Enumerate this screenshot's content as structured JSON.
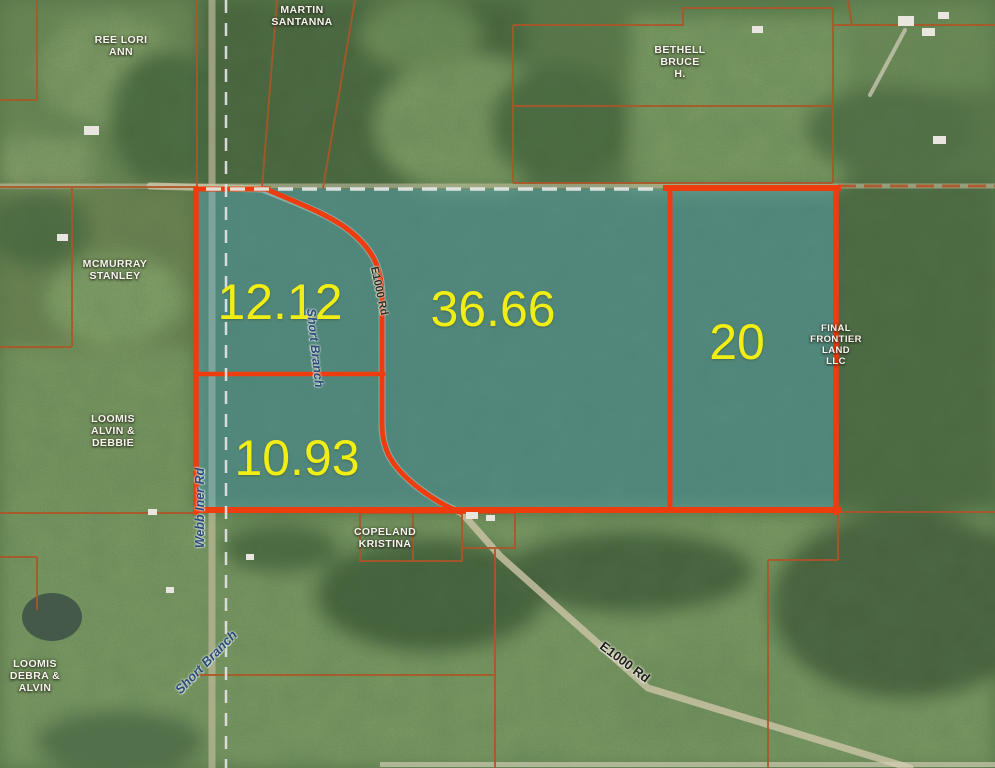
{
  "acreage_labels": {
    "p1": "12.12",
    "p2": "36.66",
    "p3": "20",
    "p4": "10.93"
  },
  "owner_labels": {
    "ree": {
      "l1": "REE LORI",
      "l2": "ANN"
    },
    "martin": {
      "l1": "MARTIN",
      "l2": "SANTANNA"
    },
    "bethell": {
      "l1": "BETHELL",
      "l2": "BRUCE",
      "l3": "H."
    },
    "mcmurray": {
      "l1": "MCMURRAY",
      "l2": "STANLEY"
    },
    "loomis_alvin": {
      "l1": "LOOMIS",
      "l2": "ALVIN &",
      "l3": "DEBBIE"
    },
    "copeland": {
      "l1": "COPELAND",
      "l2": "KRISTINA"
    },
    "loomis_debra": {
      "l1": "LOOMIS",
      "l2": "DEBRA &",
      "l3": "ALVIN"
    },
    "final_frontier": {
      "l1": "FINAL",
      "l2": "FRONTIER",
      "l3": "LAND",
      "l4": "LLC"
    }
  },
  "road_labels": {
    "e1000_upper": "E1000 Rd",
    "e1000_lower": "E1000 Rd",
    "webb": "Webb Iner Rd"
  },
  "stream_labels": {
    "short_branch_upper": "Short Branch",
    "short_branch_lower": "Short Branch"
  },
  "colors": {
    "subject_boundary": "#ee3c0e",
    "background_parcel_line": "#ad5526",
    "subject_overlay_tint": "#5aaab9",
    "acreage_text": "#f1ee15",
    "owner_text": "#f7f4ee",
    "section_dash": "#dde2e2"
  }
}
